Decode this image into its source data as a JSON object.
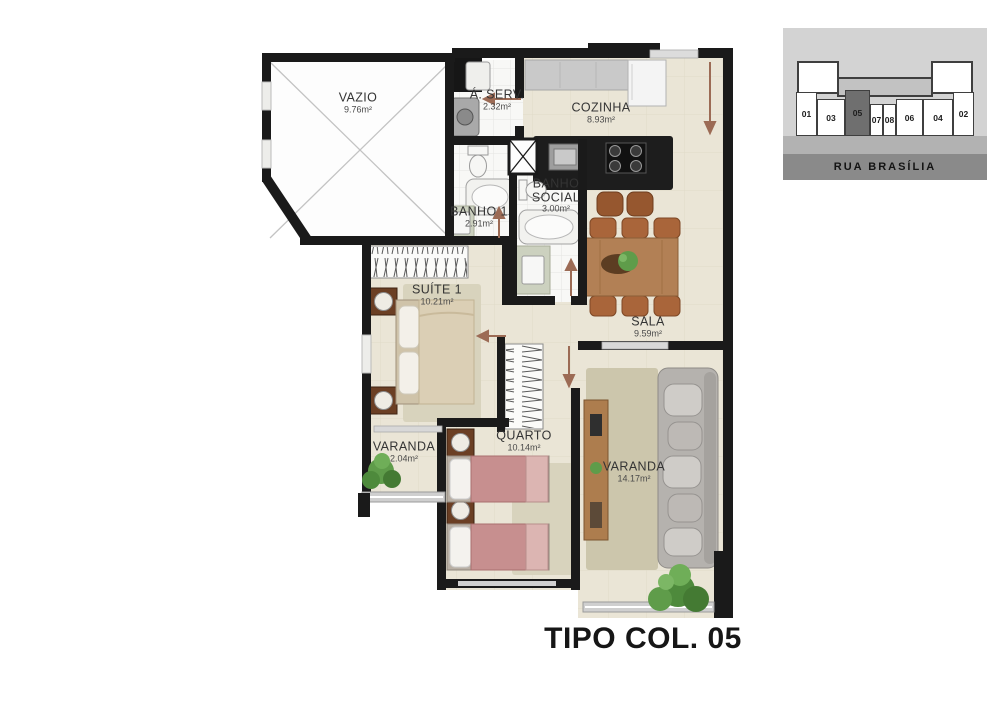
{
  "title": "TIPO COL. 05",
  "rooms": {
    "vazio": {
      "name": "VAZIO",
      "area": "9.76m²"
    },
    "aserv": {
      "name": "Á. SERV.",
      "area": "2.32m²"
    },
    "cozinha": {
      "name": "COZINHA",
      "area": "8.93m²"
    },
    "banho1": {
      "name": "BANHO 1",
      "area": "2.91m²"
    },
    "banho_social": {
      "name": "BANHO SOCIAL",
      "area": "3.00m²"
    },
    "suite": {
      "name": "SUÍTE 1",
      "area": "10.21m²"
    },
    "sala": {
      "name": "SALA",
      "area": "9.59m²"
    },
    "varanda_small": {
      "name": "VARANDA",
      "area": "2.04m²"
    },
    "quarto": {
      "name": "QUARTO",
      "area": "10.14m²"
    },
    "varanda_large": {
      "name": "VARANDA",
      "area": "14.17m²"
    }
  },
  "locator": {
    "street": "RUA BRASÍLIA",
    "highlighted_unit": "05",
    "units": [
      {
        "label": "01"
      },
      {
        "label": "03"
      },
      {
        "label": "05"
      },
      {
        "label": "07"
      },
      {
        "label": "08"
      },
      {
        "label": "06"
      },
      {
        "label": "04"
      },
      {
        "label": "02"
      }
    ]
  },
  "colors": {
    "wall": "#1a1a1a",
    "floor": "#eae5d6",
    "map_bg": "#d3d3d3",
    "sidewalk": "#b2b2b2",
    "street_band": "#8a8a8a",
    "unit_highlight": "#6f6f6f",
    "wood": "#b28055",
    "chair": "#a9653a",
    "bed_beige": "#dbcfb5",
    "bed_pink": "#c78f8f",
    "sofa": "#b5b2ae",
    "rug": "#d8d3bd",
    "plant": "#5f9c4a",
    "door_arrow": "#9c6b55",
    "counter": "#c9c9c9",
    "island": "#1d1d1d"
  }
}
